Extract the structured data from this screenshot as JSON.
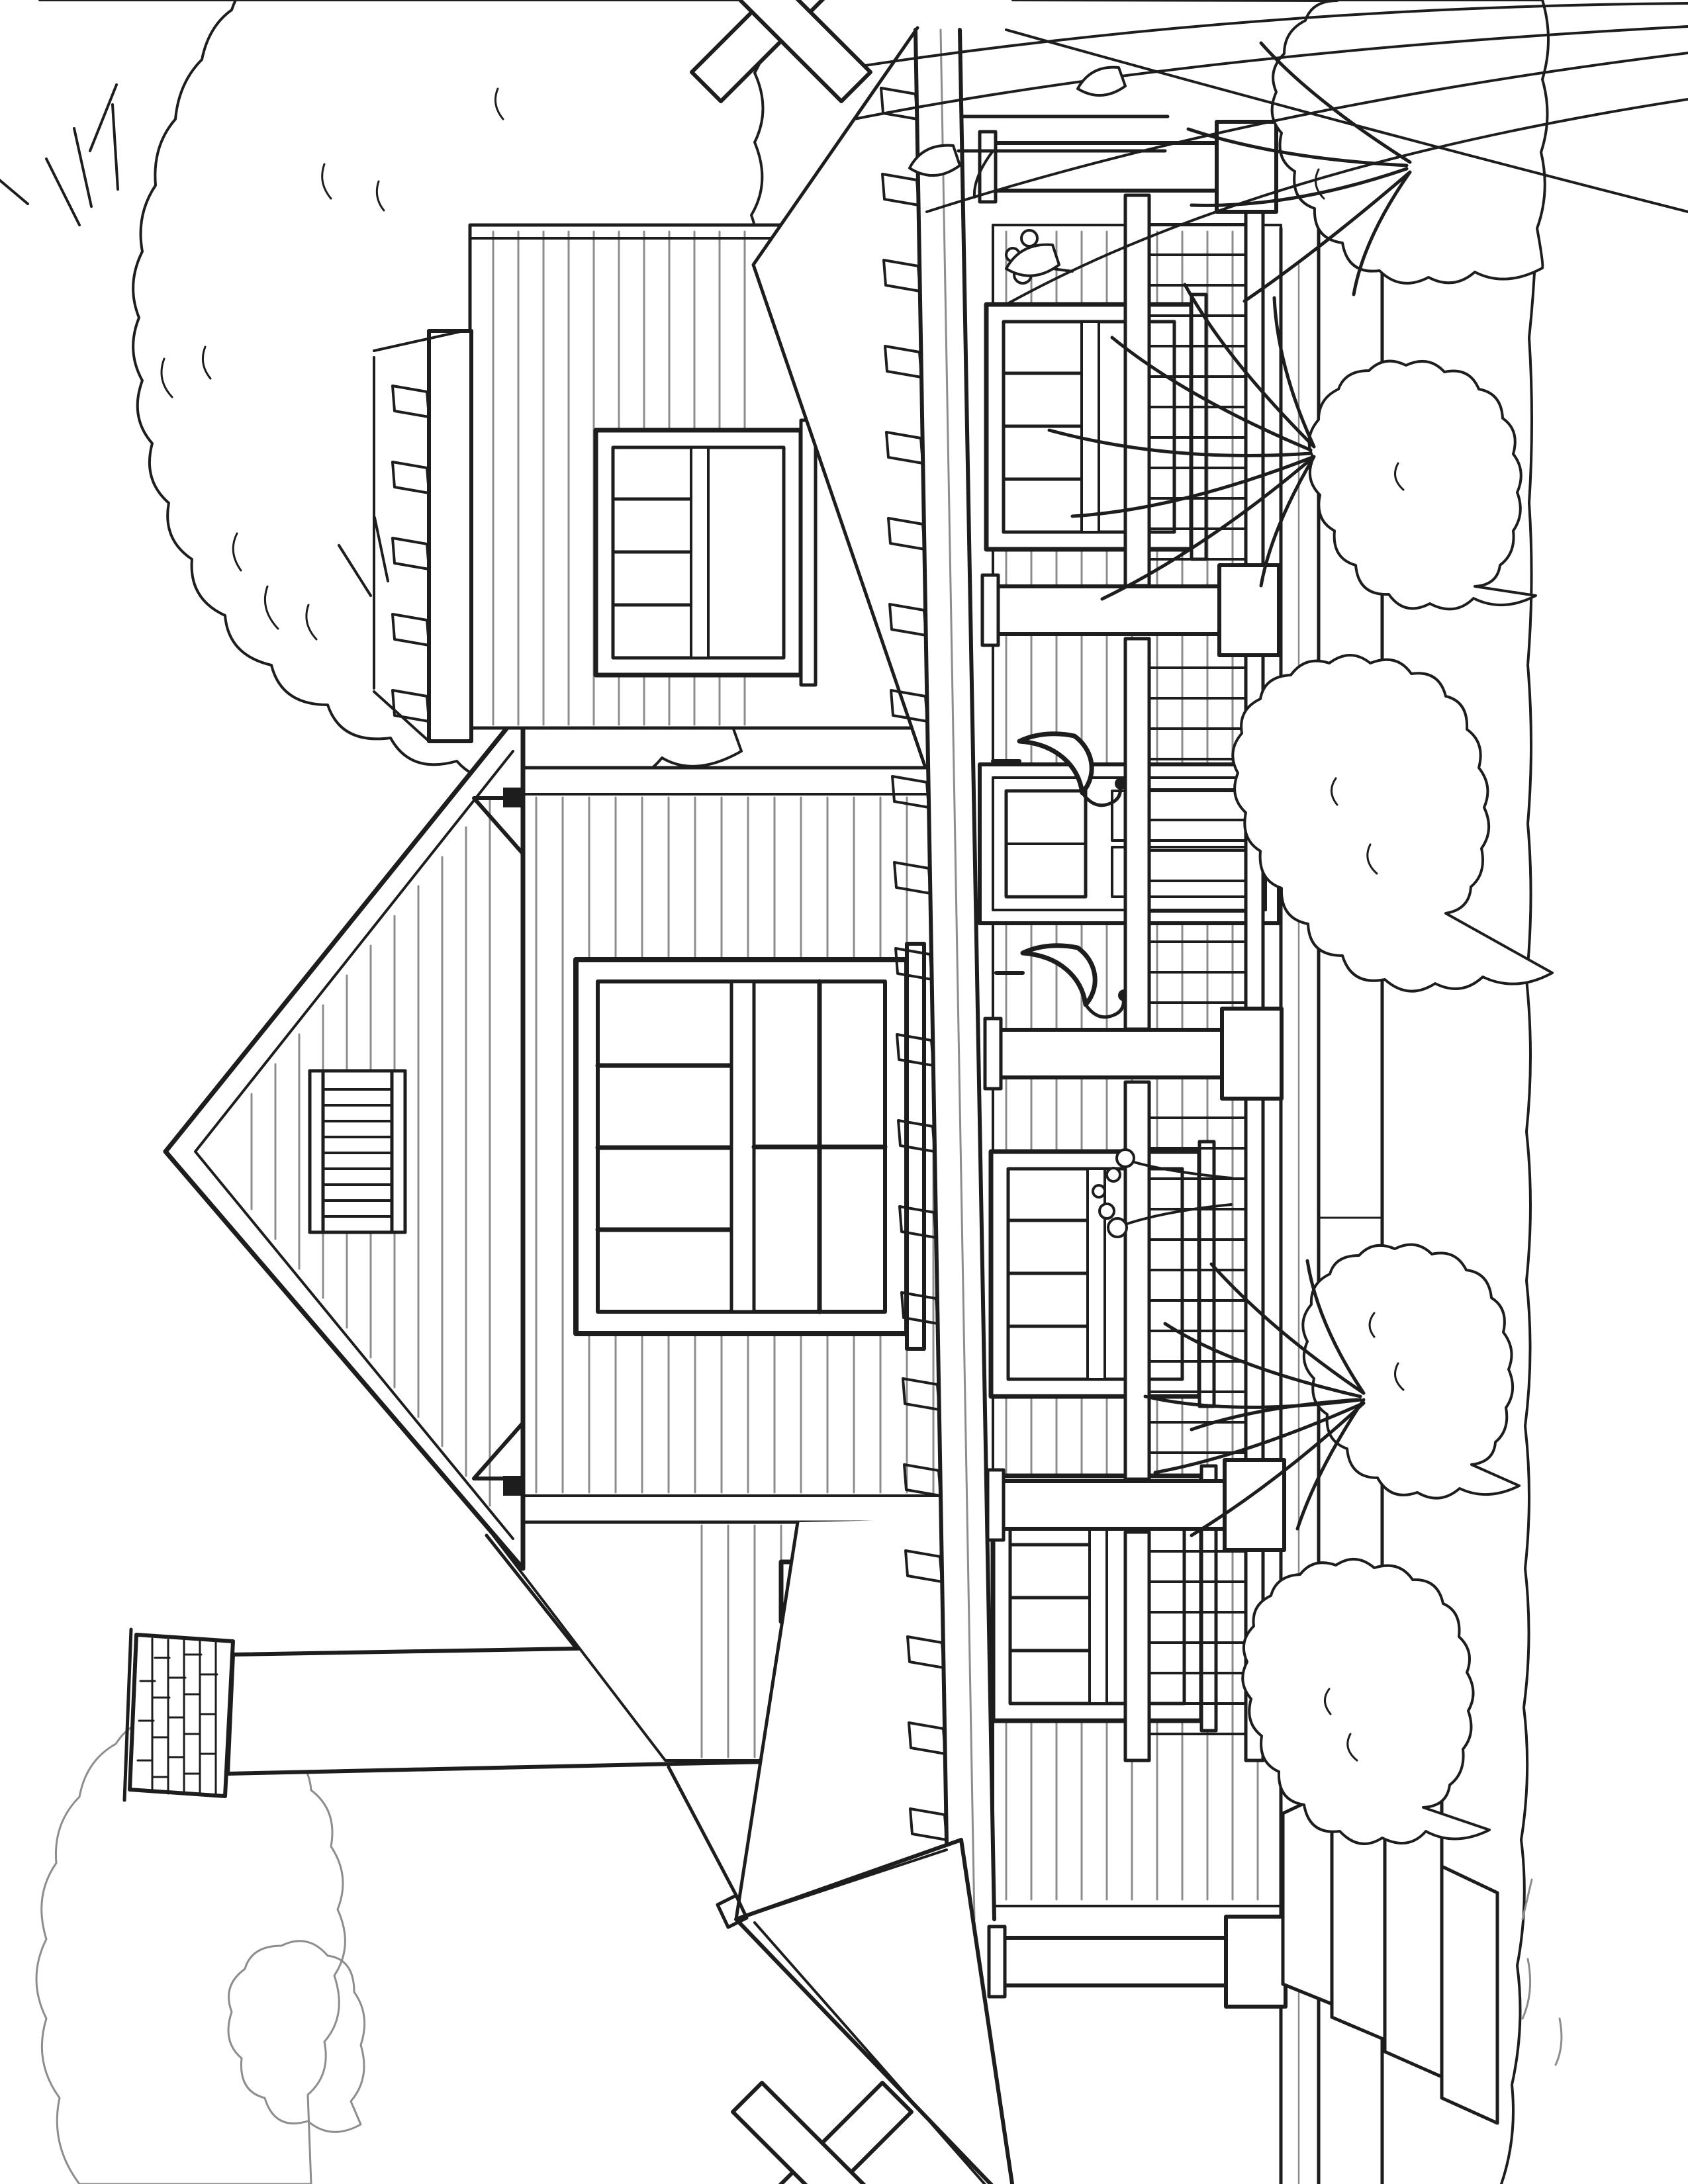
{
  "page": {
    "background": "#ffffff",
    "kind": "coloring-book line-art page",
    "orientation": "landscape artwork rotated 90 degrees on a portrait page"
  },
  "colors": {
    "paper": "#ffffff",
    "ink": "#1d1d1d",
    "light_ink": "#8d8d8d"
  },
  "scene": {
    "description": "Black-and-white line-art coloring page of a craftsman bungalow: front-facing gable with louvered vent and a large four-over-one window, side eave with exposed rafter tails, tall brick-capped chimney at left, full-width front porch with square columns on pedestals, baluster railing, hanging lantern hooks, front door, porch windows, stone front steps at the left end, foundation shrubs, spiky yucca plants, flower clusters, tall ornamental grasses at right, tree canopies behind, and crop cross marks at the page edges.",
    "elements": [
      {
        "name": "tree-canopy-right"
      },
      {
        "name": "tree-canopy-left"
      },
      {
        "name": "chimney-with-brick-cap"
      },
      {
        "name": "main-front-gable"
      },
      {
        "name": "gable-louver-vent"
      },
      {
        "name": "large-four-over-one-window"
      },
      {
        "name": "narrow-side-window"
      },
      {
        "name": "right-wing-window"
      },
      {
        "name": "main-roof-eave-rafter-tails"
      },
      {
        "name": "porch-roof-and-fascia"
      },
      {
        "name": "porch-columns"
      },
      {
        "name": "porch-railing"
      },
      {
        "name": "front-door"
      },
      {
        "name": "porch-window-left"
      },
      {
        "name": "porch-window-middle"
      },
      {
        "name": "porch-window-right"
      },
      {
        "name": "hanging-lantern-hooks"
      },
      {
        "name": "front-steps"
      },
      {
        "name": "foundation"
      },
      {
        "name": "shrubs"
      },
      {
        "name": "yucca-plants"
      },
      {
        "name": "flower-clusters"
      },
      {
        "name": "tall-grasses"
      },
      {
        "name": "ground-line"
      },
      {
        "name": "crop-cross-marks"
      }
    ]
  }
}
